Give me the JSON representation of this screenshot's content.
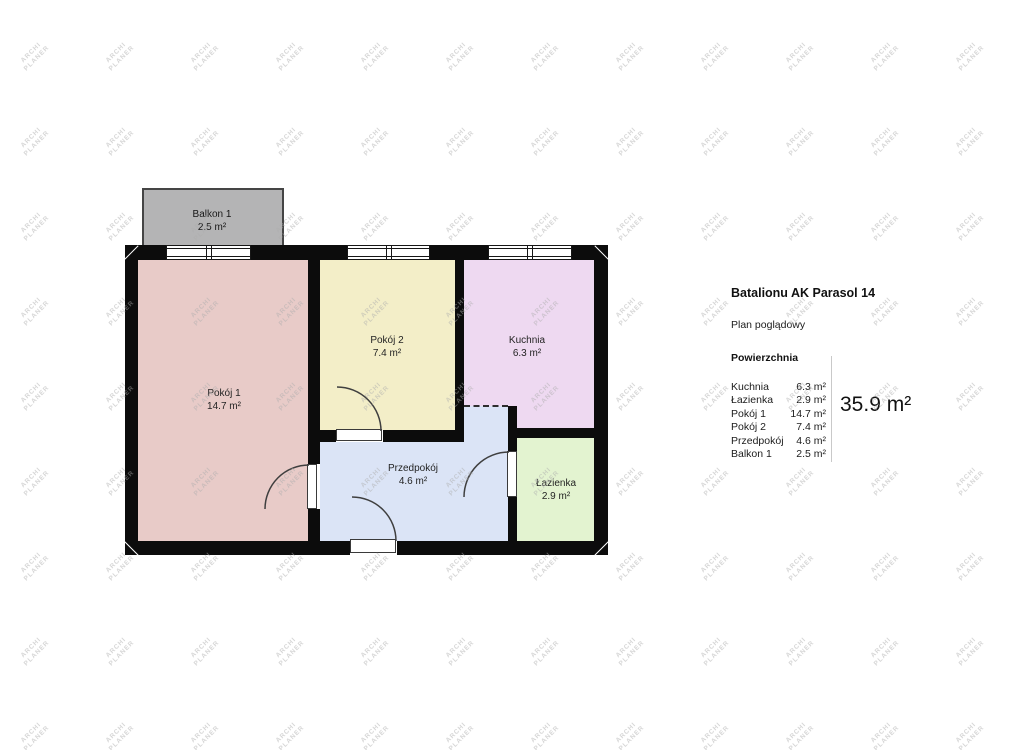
{
  "watermark": {
    "line1": "ARCHI",
    "line2": "PLANER"
  },
  "panel": {
    "title": "Batalionu AK Parasol 14",
    "subtitle": "Plan poglądowy",
    "section": "Powierzchnia",
    "rows": [
      {
        "name": "Kuchnia",
        "value": "6.3 m²"
      },
      {
        "name": "Łazienka",
        "value": "2.9 m²"
      },
      {
        "name": "Pokój 1",
        "value": "14.7 m²"
      },
      {
        "name": "Pokój 2",
        "value": "7.4 m²"
      },
      {
        "name": "Przedpokój",
        "value": "4.6 m²"
      },
      {
        "name": "Balkon 1",
        "value": "2.5 m²"
      }
    ],
    "total": "35.9 m²"
  },
  "plan": {
    "balkon": {
      "label": "Balkon 1",
      "area": "2.5 m²"
    },
    "pokoj1": {
      "label": "Pokój 1",
      "area": "14.7 m²"
    },
    "pokoj2": {
      "label": "Pokój 2",
      "area": "7.4 m²"
    },
    "kuchnia": {
      "label": "Kuchnia",
      "area": "6.3 m²"
    },
    "przedpokoj": {
      "label": "Przedpokój",
      "area": "4.6 m²"
    },
    "lazienka": {
      "label": "Łazienka",
      "area": "2.9 m²"
    }
  },
  "colors": {
    "wall": "#0c0c0c",
    "pokoj1": "#e8cbc8",
    "pokoj2": "#f3eec8",
    "kuchnia": "#eed9f1",
    "przedpokoj": "#dbe4f6",
    "lazienka": "#e3f3d0",
    "balkon": "#b4b4b5"
  }
}
